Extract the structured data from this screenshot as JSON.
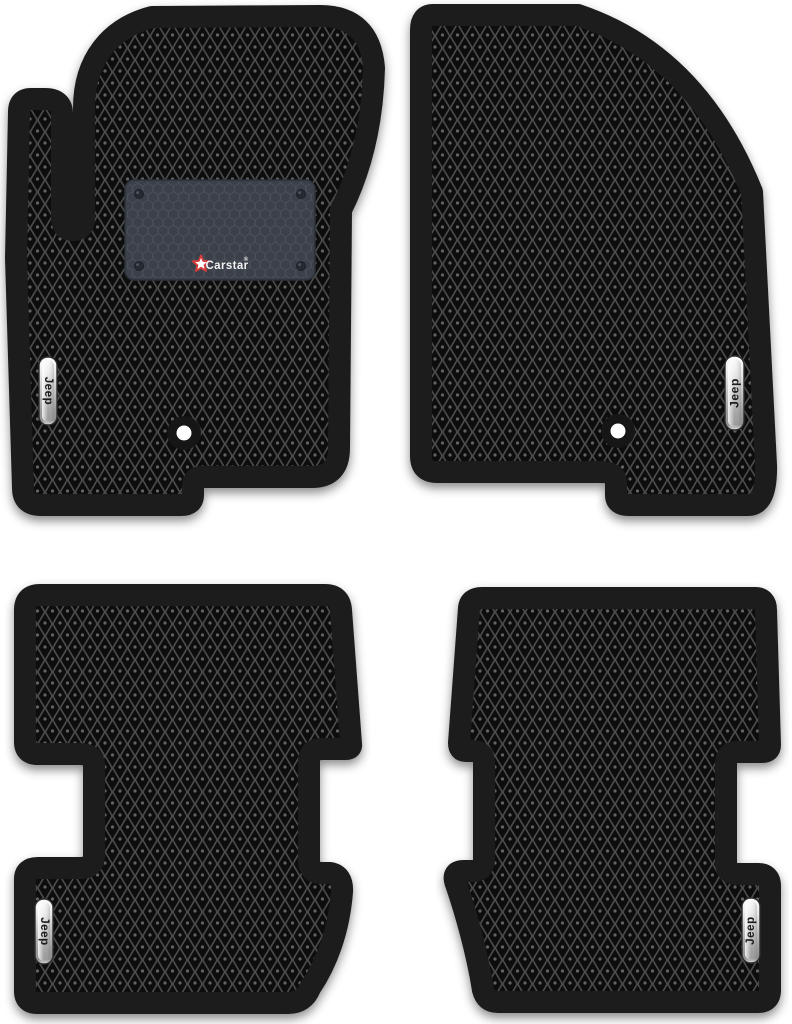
{
  "image": {
    "description": "Product photo of a four-piece set of black EVA car floor mats with rhombus cell pattern",
    "background_color": "#ffffff"
  },
  "brand_patch": {
    "brand": "Carstar",
    "reg_mark": "®",
    "patch_color": "#3a4049",
    "hex_line_color": "#4a525d",
    "star_color": "#d43a3a",
    "text_color": "#f2f2f2"
  },
  "mats": {
    "front_left": {
      "name": "driver front mat",
      "badge_text": "Jeep",
      "has_brand_patch": true,
      "has_fastener": true
    },
    "front_right": {
      "name": "passenger front mat",
      "badge_text": "Jeep",
      "has_brand_patch": false,
      "has_fastener": true
    },
    "rear_left": {
      "name": "rear left mat",
      "badge_text": "Jeep",
      "has_brand_patch": false,
      "has_fastener": false
    },
    "rear_right": {
      "name": "rear right mat",
      "badge_text": "Jeep",
      "has_brand_patch": false,
      "has_fastener": false
    }
  },
  "colors": {
    "mat_border": "#1f1f1f",
    "pattern_lattice": "#4c4c4c",
    "pattern_cell": "#0a0a0a",
    "pattern_dot": "#646464",
    "badge_chrome_light": "#fdfdfd",
    "badge_chrome_dark": "#8f8f8f",
    "fastener_center": "#ffffff",
    "fastener_ring": "#161616"
  }
}
